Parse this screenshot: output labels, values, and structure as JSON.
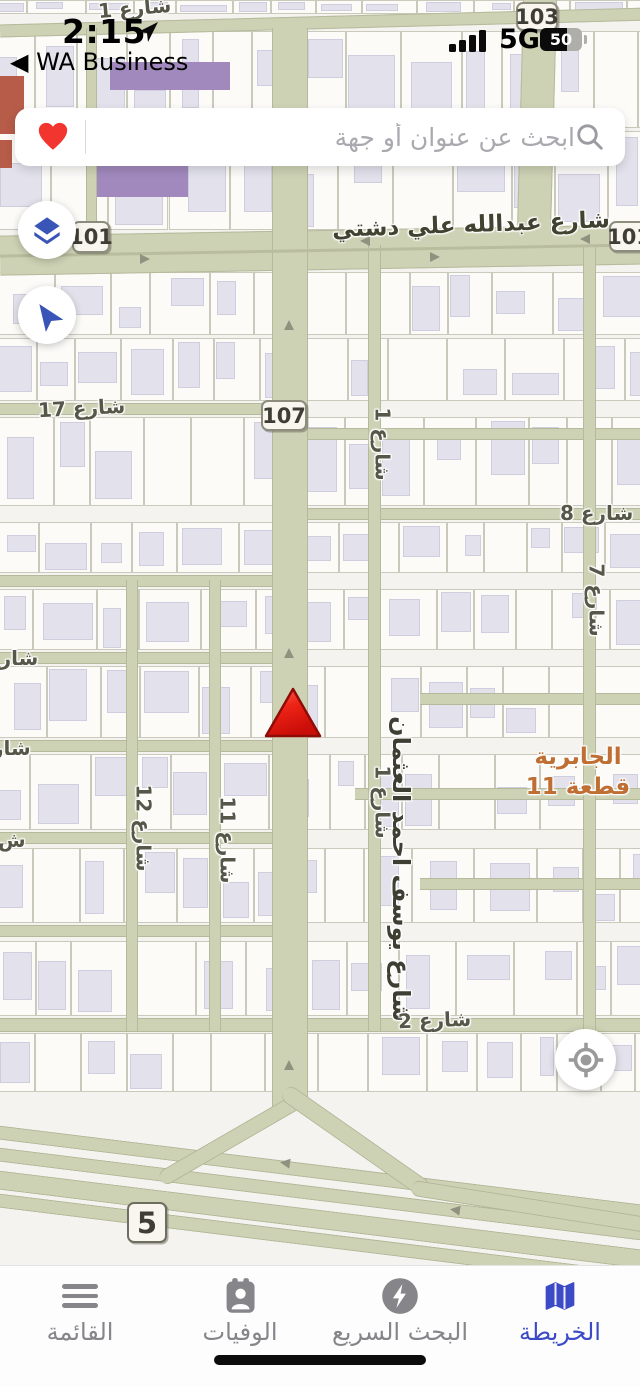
{
  "status_bar": {
    "time": "2:15",
    "back_to_app": "◀ WA Business",
    "network": "5G",
    "battery_percent": "50"
  },
  "search_bar": {
    "placeholder": "ابحث عن عنوان أو جهة"
  },
  "map": {
    "badges": {
      "b103": "103",
      "b101_left": "101",
      "b101_right": "101",
      "b107": "107",
      "b5": "5"
    },
    "streets": {
      "abdullah_ali_dashti": "شارع عبدالله علي دشتي",
      "yousef_ahmad_alothman": "شارع يوسف احمد العثمان",
      "s1_top": "شارع 1",
      "s17": "شارع 17",
      "s1_mid": "شارع 1",
      "s8": "شارع 8",
      "s7": "شارع 7",
      "s12": "شارع 12",
      "s11": "شارع 11",
      "s1_lower": "شارع 1",
      "s2": "شارع 2",
      "edge_partial_1": "شارع",
      "edge_partial_2": "شار",
      "edge_partial_3": "ش"
    },
    "area_label": {
      "line1": "الجابرية",
      "line2": "قطعة 11"
    },
    "colors": {
      "accent_blue": "#3c4bc5",
      "control_blue": "#3a55b8",
      "heart_red": "#f2352f",
      "marker_red": "#e02015",
      "area_orange": "#bf6f33",
      "road_fill": "#ced2b4"
    }
  },
  "tab_bar": {
    "items": [
      {
        "id": "menu",
        "label": "القائمة"
      },
      {
        "id": "obituaries",
        "label": "الوفيات"
      },
      {
        "id": "quick_search",
        "label": "البحث السريع"
      },
      {
        "id": "map",
        "label": "الخريطة"
      }
    ],
    "active": "الخريطة"
  }
}
